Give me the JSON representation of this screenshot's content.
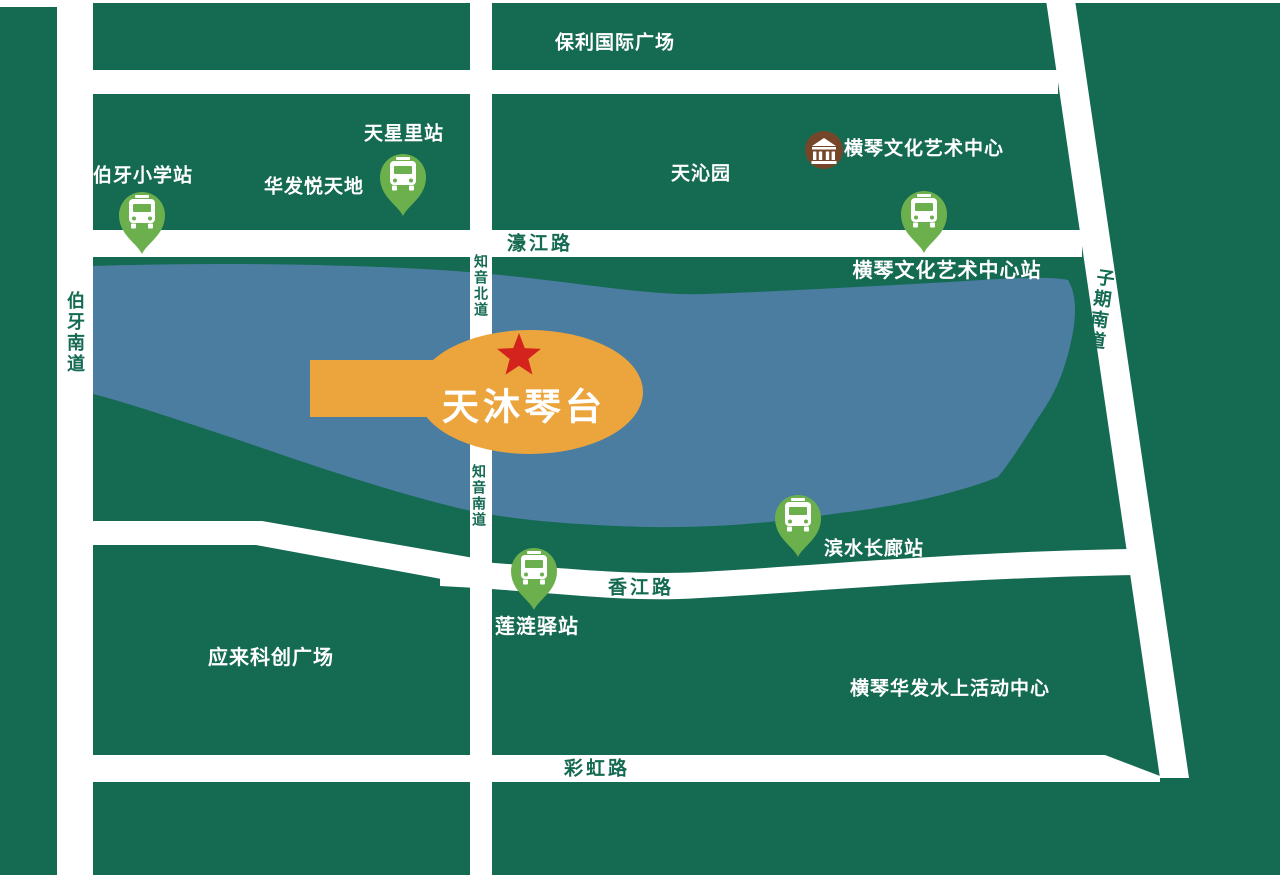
{
  "destination": {
    "label": "天沐琴台"
  },
  "landmarks": {
    "poly_plaza": "保利国际广场",
    "huafa": "华发悦天地",
    "tianqinyuan": "天沁园",
    "art_center": "横琴文化艺术中心",
    "yinglai_plaza": "应来科创广场",
    "water_center": "横琴华发水上活动中心"
  },
  "bus_stops": {
    "boya_school": "伯牙小学站",
    "tianxingli": "天星里站",
    "art_center_station": "横琴文化艺术中心站",
    "binshui_gallery": "滨水长廊站",
    "lianlian_post": "莲涟驿站"
  },
  "roads": {
    "haojiang": "濠江路",
    "zhiyin_north": "知音北道",
    "zhiyin_south": "知音南道",
    "boya_south": "伯牙南道",
    "ziqi_south": "子期南道",
    "xiangjiang": "香江路",
    "caihong": "彩虹路"
  },
  "icons": {
    "bus_stop_icon": "bus",
    "art_center_icon": "museum-building",
    "destination_icon": "red-star"
  },
  "colors": {
    "land": "#156a52",
    "road": "#ffffff",
    "lake": "#4a7da0",
    "pin": "#6cb04e",
    "callout": "#eca43d",
    "star": "#d3231c",
    "museum": "#76462a",
    "label_text": "#ffffff"
  }
}
